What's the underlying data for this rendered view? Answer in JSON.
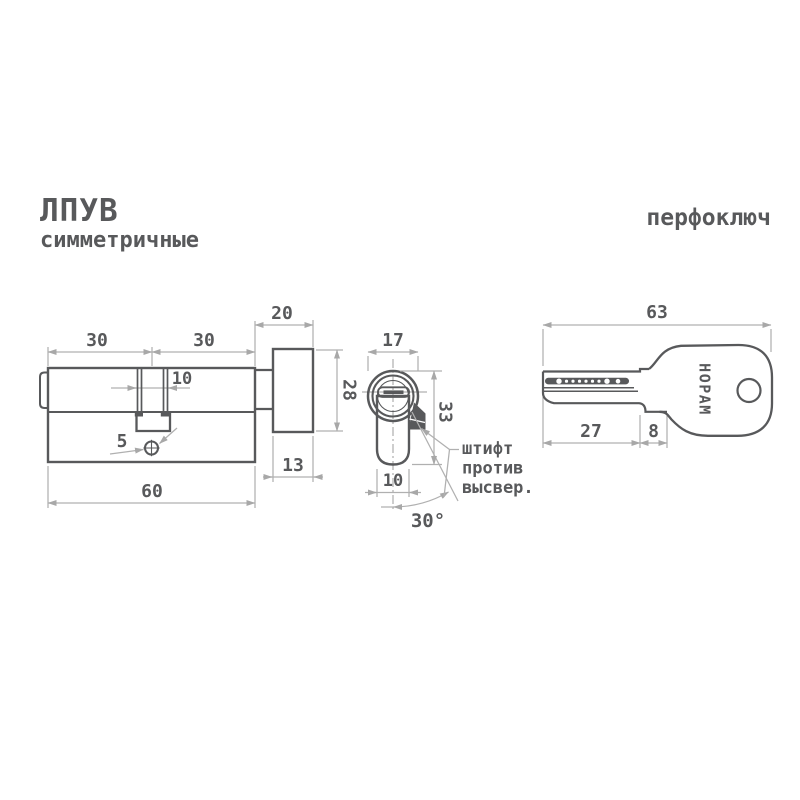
{
  "header": {
    "series": "ЛПУВ",
    "subtitle": "симметричные",
    "key_type": "перфоключ"
  },
  "colors": {
    "object_line": "#58595b",
    "dimension_line": "#b0b0b0",
    "background": "#ffffff"
  },
  "front_view": {
    "dims": {
      "left_half": "30",
      "right_half": "30",
      "knob_depth": "20",
      "cam_slot_width": "10",
      "knob_diameter": "28",
      "screw_hole": "5",
      "knob_thickness": "13",
      "total_length": "60"
    }
  },
  "section_view": {
    "dims": {
      "barrel_diameter": "17",
      "profile_height": "33",
      "profile_width": "10",
      "pin_angle": "30°"
    },
    "note_lines": [
      "штифт",
      "против",
      "высвер."
    ]
  },
  "key_view": {
    "brand": "НОРАМ",
    "dims": {
      "total_length": "63",
      "blade_length": "27",
      "shoulder_length": "8"
    }
  }
}
